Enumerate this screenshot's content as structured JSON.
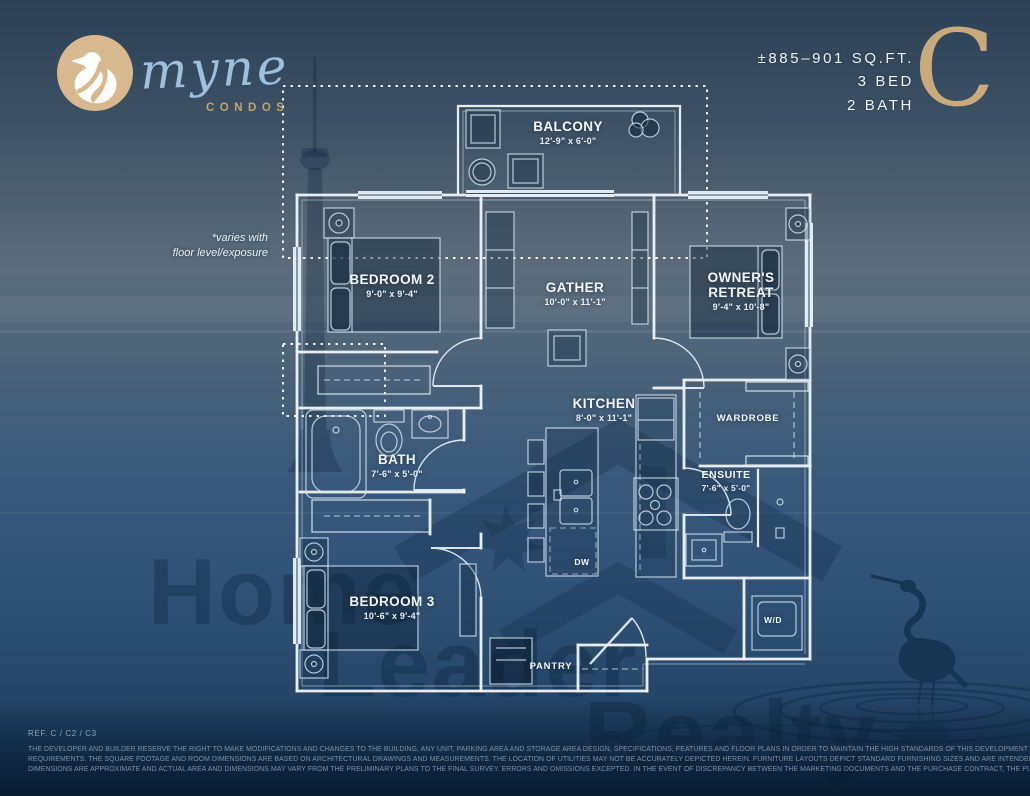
{
  "brand": {
    "name": "myne",
    "tagline": "CONDOS",
    "logo_icon": "heron-bird-in-circle"
  },
  "unit": {
    "area": "±885–901 SQ.FT.",
    "beds": "3 BED",
    "baths": "2 BATH",
    "plan_letter": "C"
  },
  "floor_note": {
    "line1": "*varies with",
    "line2": "floor level/exposure"
  },
  "rooms": {
    "balcony": {
      "name": "BALCONY",
      "dims": "12'-9\" x 6'-0\""
    },
    "bedroom2": {
      "name": "BEDROOM 2",
      "dims": "9'-0\" x 9'-4\""
    },
    "gather": {
      "name": "GATHER",
      "dims": "10'-0\" x 11'-1\""
    },
    "owners_retreat": {
      "name_line1": "OWNER'S",
      "name_line2": "RETREAT",
      "dims": "9'-4\" x 10'-8\""
    },
    "kitchen": {
      "name": "KITCHEN",
      "dims": "8'-0\" x 11'-1\""
    },
    "bath": {
      "name": "BATH",
      "dims": "7'-6\" x 5'-0\""
    },
    "wardrobe": {
      "name": "WARDROBE"
    },
    "ensuite": {
      "name": "ENSUITE",
      "dims": "7'-6\" x 5'-0\""
    },
    "bedroom3": {
      "name": "BEDROOM 3",
      "dims": "10'-6\" x 9'-4\""
    },
    "pantry": {
      "name": "PANTRY"
    },
    "washer_dryer": {
      "name": "W/D"
    },
    "dishwasher": {
      "name": "DW"
    }
  },
  "watermark": {
    "line1": "Home",
    "line2": "Leader",
    "line3": "Realty"
  },
  "footer": {
    "ref": "REF. C / C2 / C3",
    "disclaimer_line1": "THE DEVELOPER AND BUILDER RESERVE THE RIGHT TO MAKE MODIFICATIONS AND CHANGES TO THE BUILDING, ANY UNIT, PARKING AREA AND STORAGE AREA DESIGN, SPECIFICATIONS, FEATURES AND FLOOR PLANS IN ORDER TO MAINTAIN THE HIGH STANDARDS OF THIS DEVELOPMENT OR TO COMPLY WITH MUNICIPAL",
    "disclaimer_line2": "REQUIREMENTS. THE SQUARE FOOTAGE AND ROOM DIMENSIONS ARE BASED ON ARCHITECTURAL DRAWINGS AND MEASUREMENTS. THE LOCATION OF UTILITIES MAY NOT BE ACCURATELY DEPICTED HEREIN. FURNITURE LAYOUTS DEPICT STANDARD FURNISHING SIZES AND ARE INTENDED FOR REFERENCE ONLY. ALL SIZES AND",
    "disclaimer_line3": "DIMENSIONS ARE APPROXIMATE AND ACTUAL AREA AND DIMENSIONS MAY VARY FROM THE PRELIMINARY PLANS TO THE FINAL SURVEY. ERRORS AND OMISSIONS EXCEPTED. IN THE EVENT OF DISCREPANCY BETWEEN THE MARKETING DOCUMENTS AND THE PURCHASE CONTRACT, THE PURCHASE CONTRACT WILL PREVAIL."
  },
  "colors": {
    "accent_tan": "#d2b086",
    "script_blue": "#9cc0de",
    "background_navy": "#31465c",
    "plan_line_white": "#eef4f9"
  }
}
